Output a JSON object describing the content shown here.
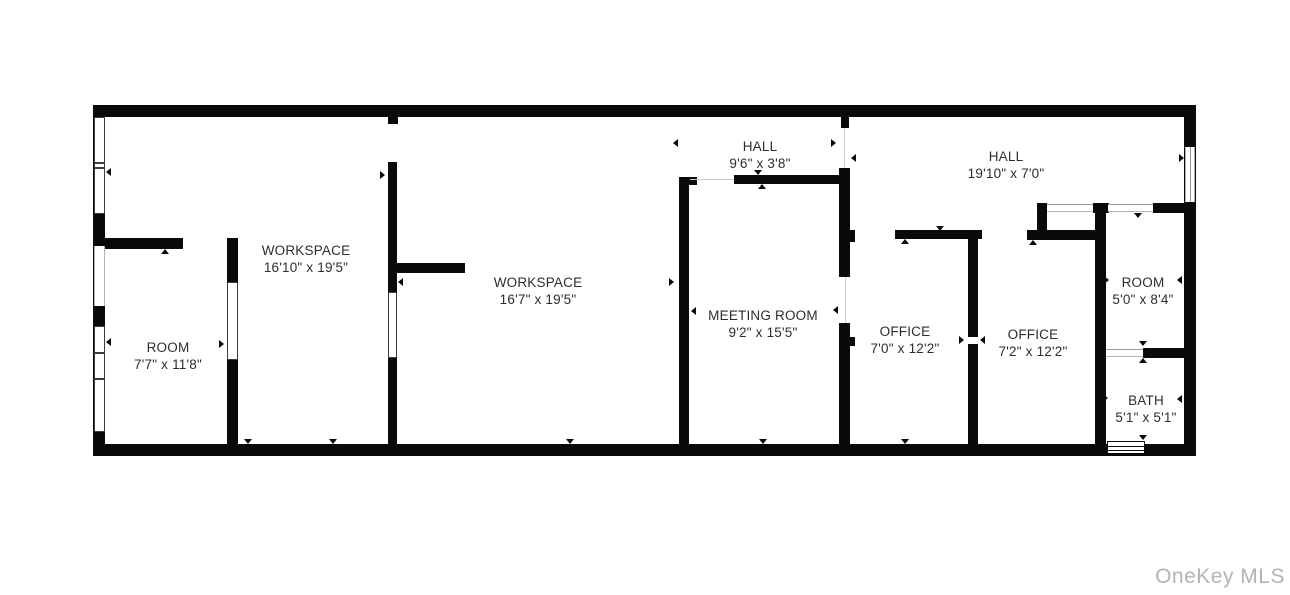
{
  "watermark": "OneKey MLS",
  "colors": {
    "wall": "#0a0a0a",
    "label_text": "#2d2d2d",
    "watermark_text": "#b3b3b8",
    "background": "#ffffff"
  },
  "rooms": [
    {
      "name": "ROOM",
      "dims": "7'7\" x 11'8\""
    },
    {
      "name": "WORKSPACE",
      "dims": "16'10\" x 19'5\""
    },
    {
      "name": "WORKSPACE",
      "dims": "16'7\" x 19'5\""
    },
    {
      "name": "HALL",
      "dims": "9'6\" x 3'8\""
    },
    {
      "name": "MEETING ROOM",
      "dims": "9'2\" x 15'5\""
    },
    {
      "name": "HALL",
      "dims": "19'10\" x 7'0\""
    },
    {
      "name": "OFFICE",
      "dims": "7'0\" x 12'2\""
    },
    {
      "name": "OFFICE",
      "dims": "7'2\" x 12'2\""
    },
    {
      "name": "ROOM",
      "dims": "5'0\" x 8'4\""
    },
    {
      "name": "BATH",
      "dims": "5'1\" x 5'1\""
    }
  ]
}
